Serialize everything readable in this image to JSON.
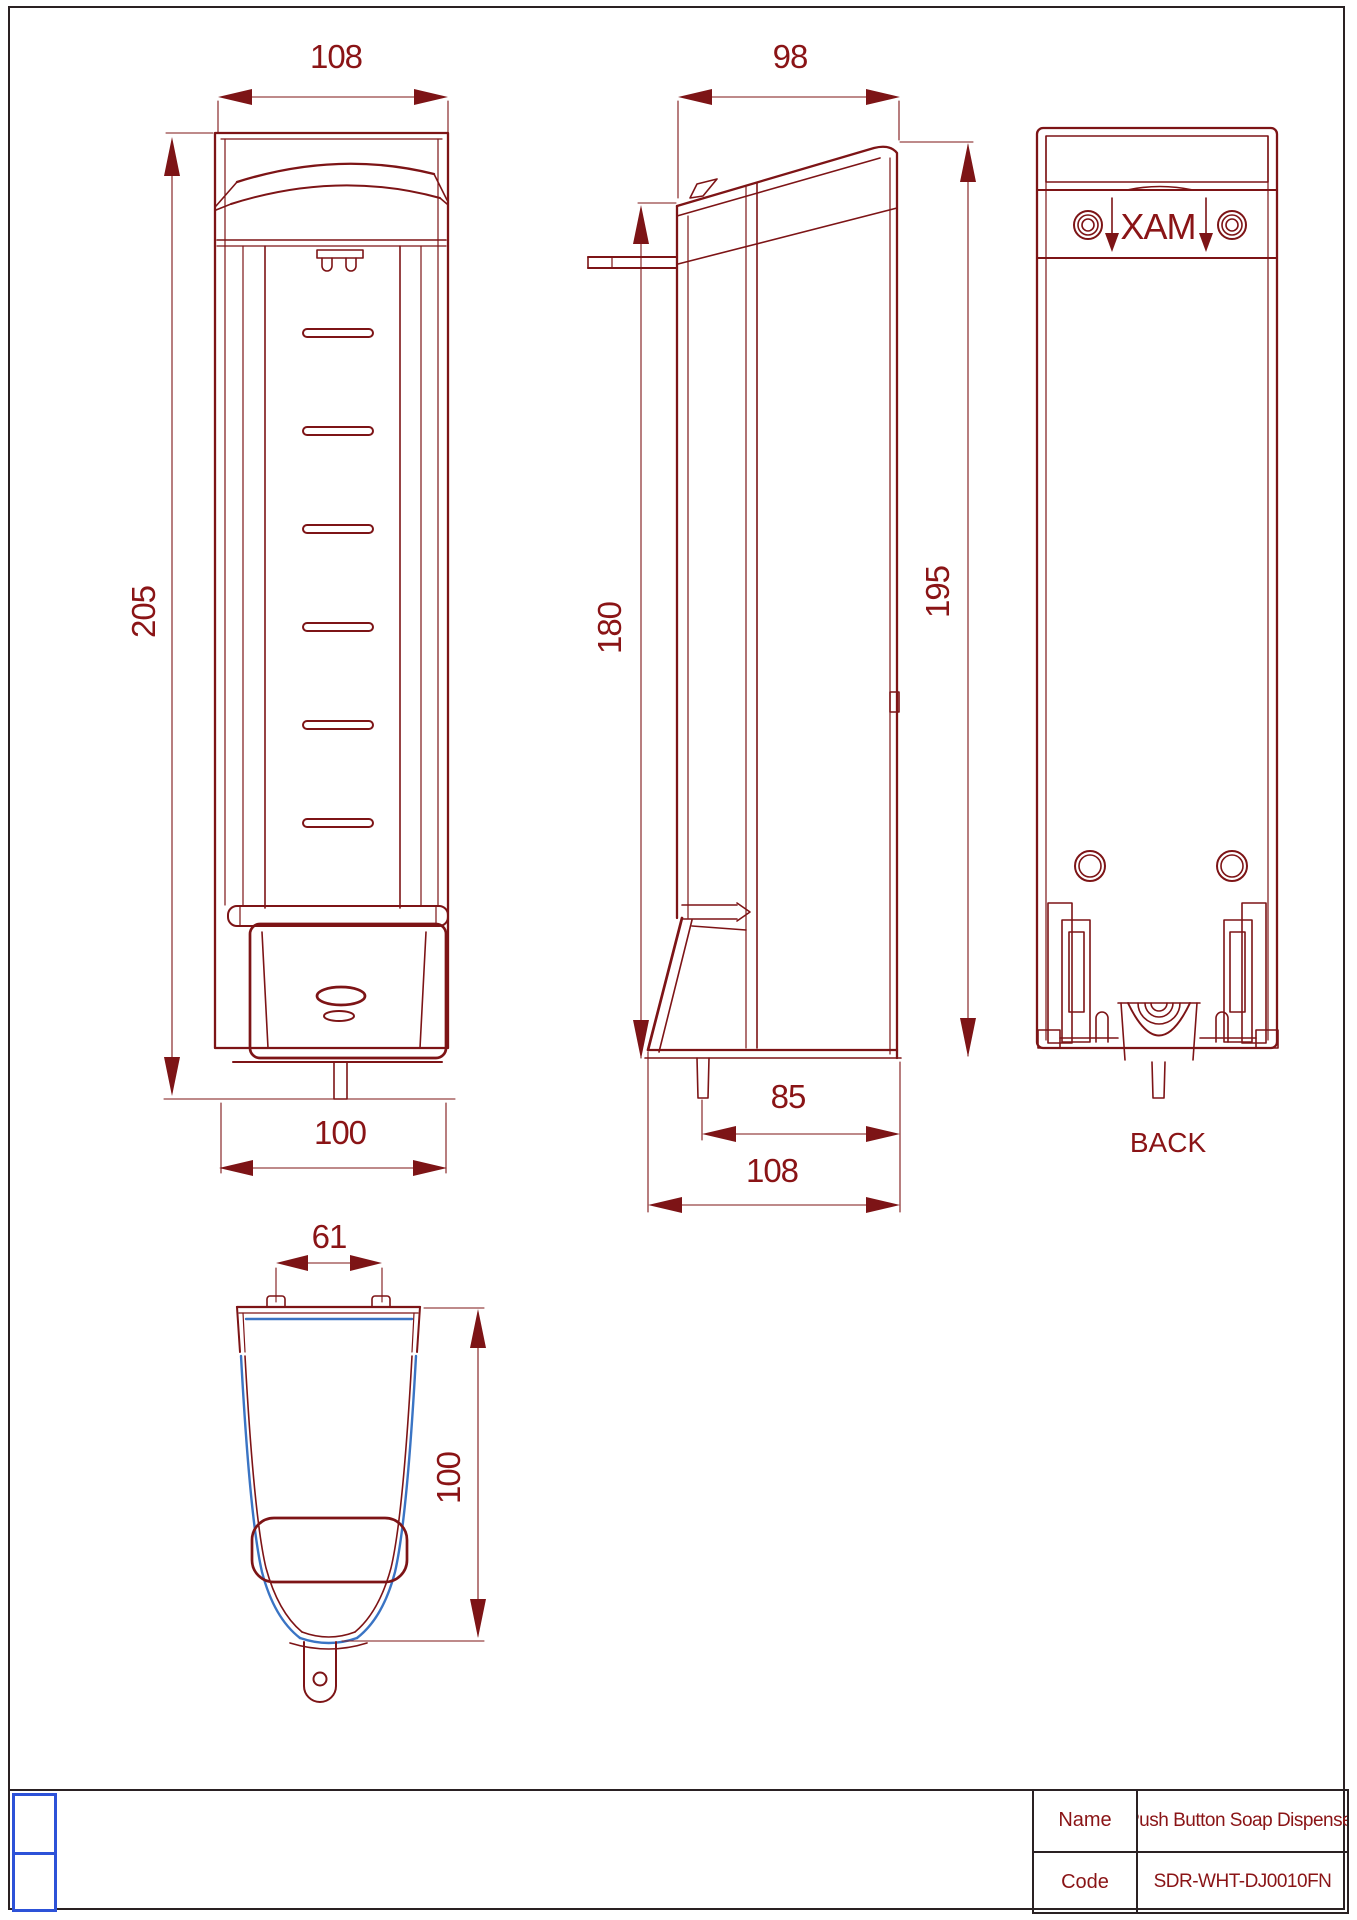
{
  "colors": {
    "ink": "#7d1416",
    "dimension_text": "#8a1416",
    "accent_blue": "#3a74c4",
    "logo_blue": "#2d52d8",
    "frame": "#2a2123"
  },
  "views": {
    "front": {
      "dim_width_top": "108",
      "dim_height": "205",
      "dim_width_bottom": "100"
    },
    "side": {
      "dim_depth_top": "98",
      "dim_height_front": "180",
      "dim_height_back": "195",
      "dim_nozzle_to_back": "85",
      "dim_depth_bottom": "108"
    },
    "back": {
      "max_marking": "MAX",
      "caption": "BACK"
    },
    "bottom": {
      "dim_bracket_width": "61",
      "dim_depth": "100"
    }
  },
  "title_block": {
    "name_label": "Name",
    "name_value": "Push Button Soap Dispenser",
    "code_label": "Code",
    "code_value": "SDR-WHT-DJ0010FN"
  }
}
